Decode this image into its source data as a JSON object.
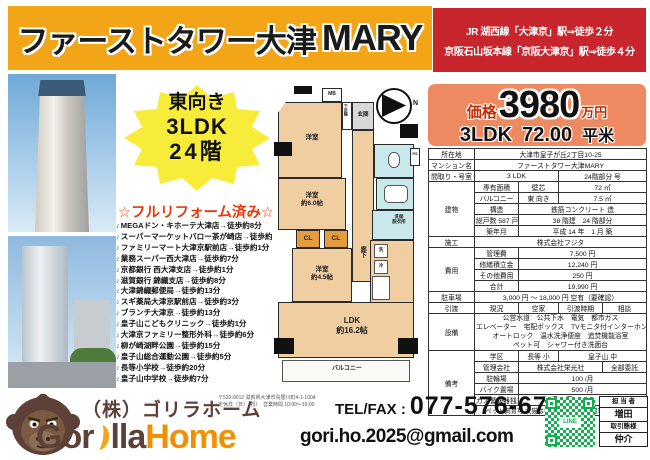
{
  "header": {
    "title_jp": "ファーストタワー大津",
    "title_en": "MARY",
    "access_line1": "JR 湖西線「大津京」駅⇒徒歩２分",
    "access_line2": "京阪石山坂本線「京阪大津京」駅⇒徒歩４分"
  },
  "price": {
    "label": "価格",
    "value": "3980",
    "unit": "万円",
    "layout": "3LDK",
    "area": "72.00",
    "area_unit": "平米"
  },
  "badge": {
    "line1": "東向き",
    "line2": "3LDK",
    "line3": "24階"
  },
  "reform_text": "☆フルリフォーム済み☆",
  "misc": {
    "bullet": "♪",
    "compass_n": "N"
  },
  "facilities": [
    "MEGAドン・キホーテ大津店→徒歩約8分",
    "スーパーマーケットバロー茶が崎店→徒歩約8分",
    "ファミリーマート大津京駅前店→徒歩約1分",
    "業務スーパー西大津店→徒歩約7分",
    "京都銀行 西大津支店→徒歩約1分",
    "滋賀銀行 錦織支店→徒歩約8分",
    "大津錦織郵便局→徒歩約13分",
    "スギ薬局大津京駅前店→徒歩約3分",
    "ブランチ大津京→徒歩約13分",
    "皇子山こどもクリニック→徒歩約1分",
    "大津京ファミリー整形外科→徒歩約6分",
    "柳が崎湖畔公園→徒歩約15分",
    "皇子山総合運動公園→徒歩約5分",
    "長等小学校→徒歩約20分",
    "皇子山中学校→徒歩約7分"
  ],
  "floorplan": {
    "mb": "MB",
    "genkan": "玄関",
    "shoebox": "下足箱",
    "room_top": "洋室",
    "room_mid": "洋室\n約6.0帖",
    "cl1": "CL",
    "cl2": "CL",
    "room_small": "洋室\n約4.5帖",
    "corridor": "廊下",
    "washroom": "洗面\n脱衣所",
    "ps": "PS",
    "wash": "洗",
    "fridge": "冷",
    "ldk": "LDK\n約16.2帖",
    "balcony": "バルコニー"
  },
  "details": {
    "loc_label": "所在地",
    "loc": "大津市皇子が丘2丁目10-25",
    "name_label": "マンション名",
    "name": "ファーストタワー大津MARY",
    "layout_label": "間取り・号室",
    "layout": "3 LDK",
    "layout_floor": "24階部分 号",
    "building_label": "建物",
    "area_label": "専有面積",
    "area_type": "壁芯",
    "area": "72 ㎡",
    "balc_label": "バルコニー",
    "balc_dir": "東 向き",
    "balc_area": "7.5 ㎡",
    "struct_label": "構造",
    "struct": "鉄筋コンクリート 造",
    "units": "総戸数 587 戸",
    "floors": "38 階建　24 階部分",
    "built_label": "築年月",
    "built": "平成 14 年　1 月 築",
    "const_label": "施工",
    "const_co": "株式会社フジタ",
    "cost_label": "費用",
    "mgmt_label": "管理費",
    "mgmt": "7,500 円",
    "repair_label": "修繕積立金",
    "repair": "12,240 円",
    "other_label": "その他費用",
    "other": "250 円",
    "total_label": "合計",
    "total": "19,990 円",
    "park_label": "駐車場",
    "park": "3,000 円 ～ 18,000 円 空有（要確認）",
    "hand_label": "引渡",
    "hand_now": "現況",
    "hand_state": "空家",
    "hand_time_label": "引渡時期",
    "hand_time": "相談",
    "equip_label": "設備",
    "equip1": "公営水道　公共下水　電気　都市ガス",
    "equip2": "エレベーター　宅配ボックス　TVモニタ付インターホン",
    "equip3": "オートロック　温水洗浄便座　追焚機能浴室",
    "equip4": "ペット可　シャワー付き洗面台",
    "remarks_label": "備考",
    "school_label": "学区",
    "school1": "長等 小",
    "school2": "皇子山 中",
    "mgmtco_label": "管理会社",
    "mgmtco": "株式会社栄光社",
    "mgmtco_type": "全部委託",
    "cycle_label": "駐輪場",
    "cycle": "100 /月",
    "bike_label": "バイク置場",
    "bike": "500 /月",
    "gas_label": "ガス警報器独立",
    "gas": "250 /月",
    "pet_note": "ペット飼育可 犬猫は各住戸1匹まで（管理規約参照）"
  },
  "footer": {
    "company": "（株）ゴリラホーム",
    "addr1": "〒520-0012 滋賀県大津市鳥居川町4-1-1004",
    "addr2": "定休日（日）（祝）　営業時間 10:00～19:00",
    "tel_label": "TEL/FAX :",
    "tel": "077-576-6763",
    "logo1": "Gor",
    "logo2": "lla",
    "logo3": "Home",
    "email": "gori.ho.2025@gmail.com",
    "qr_text": "LINE",
    "agent_label": "担 当 者",
    "agent_name": "増田",
    "deal_label": "取引態様",
    "deal_type": "仲介"
  }
}
